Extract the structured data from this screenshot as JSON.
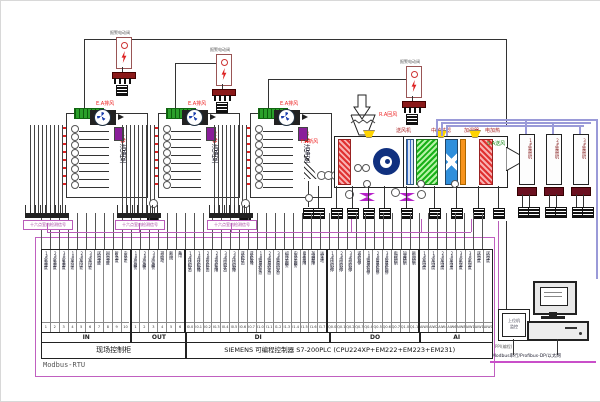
{
  "alarm_units": {
    "label": "报警电动阀",
    "items": [
      {
        "x": 115,
        "y": 36,
        "wire_x": 83,
        "wire_y": 38,
        "wire_to": 505
      },
      {
        "x": 215,
        "y": 53,
        "wire_x": 174,
        "wire_y": 62,
        "wire_to": 230
      },
      {
        "x": 405,
        "y": 65,
        "wire_x": 267,
        "wire_y": 78,
        "wire_to": 420
      }
    ]
  },
  "clean_rooms": {
    "exhaust_label": "E.A排风",
    "items": [
      {
        "num": "1#",
        "name": "洁净室",
        "x": 65
      },
      {
        "num": "2#",
        "name": "洁净室",
        "x": 157
      },
      {
        "num": "3#",
        "name": "洁净室",
        "x": 249
      }
    ],
    "junction_label": "十六点室内检测信号"
  },
  "ahu": {
    "fresh_air_label": "F.A新风",
    "return_air_label": "R.A回风",
    "supply_fan_label": "送风机",
    "filter_label": "中效过滤",
    "humidifier_label": "加湿器",
    "heater_label": "电加热",
    "supply_air_label": "S.A送风"
  },
  "duct_fans": {
    "items": [
      {
        "label": "1#管道风机",
        "x": 518
      },
      {
        "label": "2#管道风机",
        "x": 545
      },
      {
        "label": "3#管道风机",
        "x": 572
      }
    ]
  },
  "io_table": {
    "sections": [
      {
        "name": "IN",
        "columns": [
          {
            "label": "1#室温湿度",
            "code": "1"
          },
          {
            "label": "2#室温湿度",
            "code": "2"
          },
          {
            "label": "3#室温湿度",
            "code": "3"
          },
          {
            "label": "1#室内压差",
            "code": "4"
          },
          {
            "label": "2#室内压差",
            "code": "5"
          },
          {
            "label": "3#室内压差",
            "code": "6"
          },
          {
            "label": "送风温湿度",
            "code": "7"
          },
          {
            "label": "回风温湿度",
            "code": "8"
          },
          {
            "label": "新风温度",
            "code": "9"
          },
          {
            "label": "中效压差",
            "code": "10"
          }
        ]
      },
      {
        "name": "OUT",
        "columns": [
          {
            "label": "1#声光报警",
            "code": "1"
          },
          {
            "label": "2#声光报警",
            "code": "2"
          },
          {
            "label": "3#声光报警",
            "code": "3"
          },
          {
            "label": "排风联动",
            "code": "4"
          },
          {
            "label": "新风阀",
            "code": "5"
          },
          {
            "label": "备用",
            "code": "6"
          }
        ]
      },
      {
        "name": "DI",
        "columns": [
          {
            "label": "1#排风机状态",
            "code": "I0.0"
          },
          {
            "label": "1#排风机故障",
            "code": "I0.1"
          },
          {
            "label": "2#排风机状态",
            "code": "I0.2"
          },
          {
            "label": "2#排风机故障",
            "code": "I0.3"
          },
          {
            "label": "3#排风机状态",
            "code": "I0.4"
          },
          {
            "label": "3#排风机故障",
            "code": "I0.5"
          },
          {
            "label": "送风机状态",
            "code": "I0.6"
          },
          {
            "label": "送风机故障",
            "code": "I0.7"
          },
          {
            "label": "1#管道风机状态",
            "code": "I1.0"
          },
          {
            "label": "2#管道风机状态",
            "code": "I1.1"
          },
          {
            "label": "3#管道风机状态",
            "code": "I1.2"
          },
          {
            "label": "初效压差报警",
            "code": "I1.3"
          },
          {
            "label": "中效压差报警",
            "code": "I1.4"
          },
          {
            "label": "电加热故障",
            "code": "I1.5"
          },
          {
            "label": "加湿器故障",
            "code": "I1.6"
          },
          {
            "label": "远程本地",
            "code": "I1.7"
          }
        ]
      },
      {
        "name": "DO",
        "columns": [
          {
            "label": "1#排风机启停",
            "code": "Q0.0"
          },
          {
            "label": "2#排风机启停",
            "code": "Q0.1"
          },
          {
            "label": "3#排风机启停",
            "code": "Q0.2"
          },
          {
            "label": "送风机启停",
            "code": "Q0.3"
          },
          {
            "label": "1#管道风机启停",
            "code": "Q0.4"
          },
          {
            "label": "2#管道风机启停",
            "code": "Q0.5"
          },
          {
            "label": "3#管道风机启停",
            "code": "Q0.6"
          },
          {
            "label": "电加热控制",
            "code": "Q0.7"
          },
          {
            "label": "加湿器控制",
            "code": "Q1.0"
          },
          {
            "label": "新风阀控制",
            "code": "Q1.1"
          }
        ]
      },
      {
        "name": "AI",
        "columns": [
          {
            "label": "1#室内温度",
            "code": "AIW0"
          },
          {
            "label": "1#室内湿度",
            "code": "AIW2"
          },
          {
            "label": "2#室内温度",
            "code": "AIW4"
          },
          {
            "label": "2#室内湿度",
            "code": "AIW6"
          },
          {
            "label": "3#室内温度",
            "code": "AIW8"
          },
          {
            "label": "3#室内湿度",
            "code": "AIW10"
          },
          {
            "label": "送风温度",
            "code": "AIW12"
          },
          {
            "label": "送风湿度",
            "code": "AIW14"
          }
        ]
      }
    ],
    "cabinet_label": "现场控制柜",
    "plc_label": "SIEMENS   可编程控制器 S7-200PLC (CPU224XP+EM222+EM223+EM231)",
    "bus_label": "Modbus-RTU"
  },
  "monitor_station": {
    "host_label_line1": "上位机",
    "host_label_line2": "监控",
    "ppi_label": "PPI(编程)",
    "link_label": "Modbus串行/Profibus-DP/以太网"
  },
  "colors": {
    "purple_accent": "#b95cb9",
    "duct_purple": "#9a9ad8",
    "alarm_red": "#e22222",
    "supply_green": "#1a8a1a",
    "terminal_green": "#2aa02a",
    "fan_navy": "#10307f"
  }
}
